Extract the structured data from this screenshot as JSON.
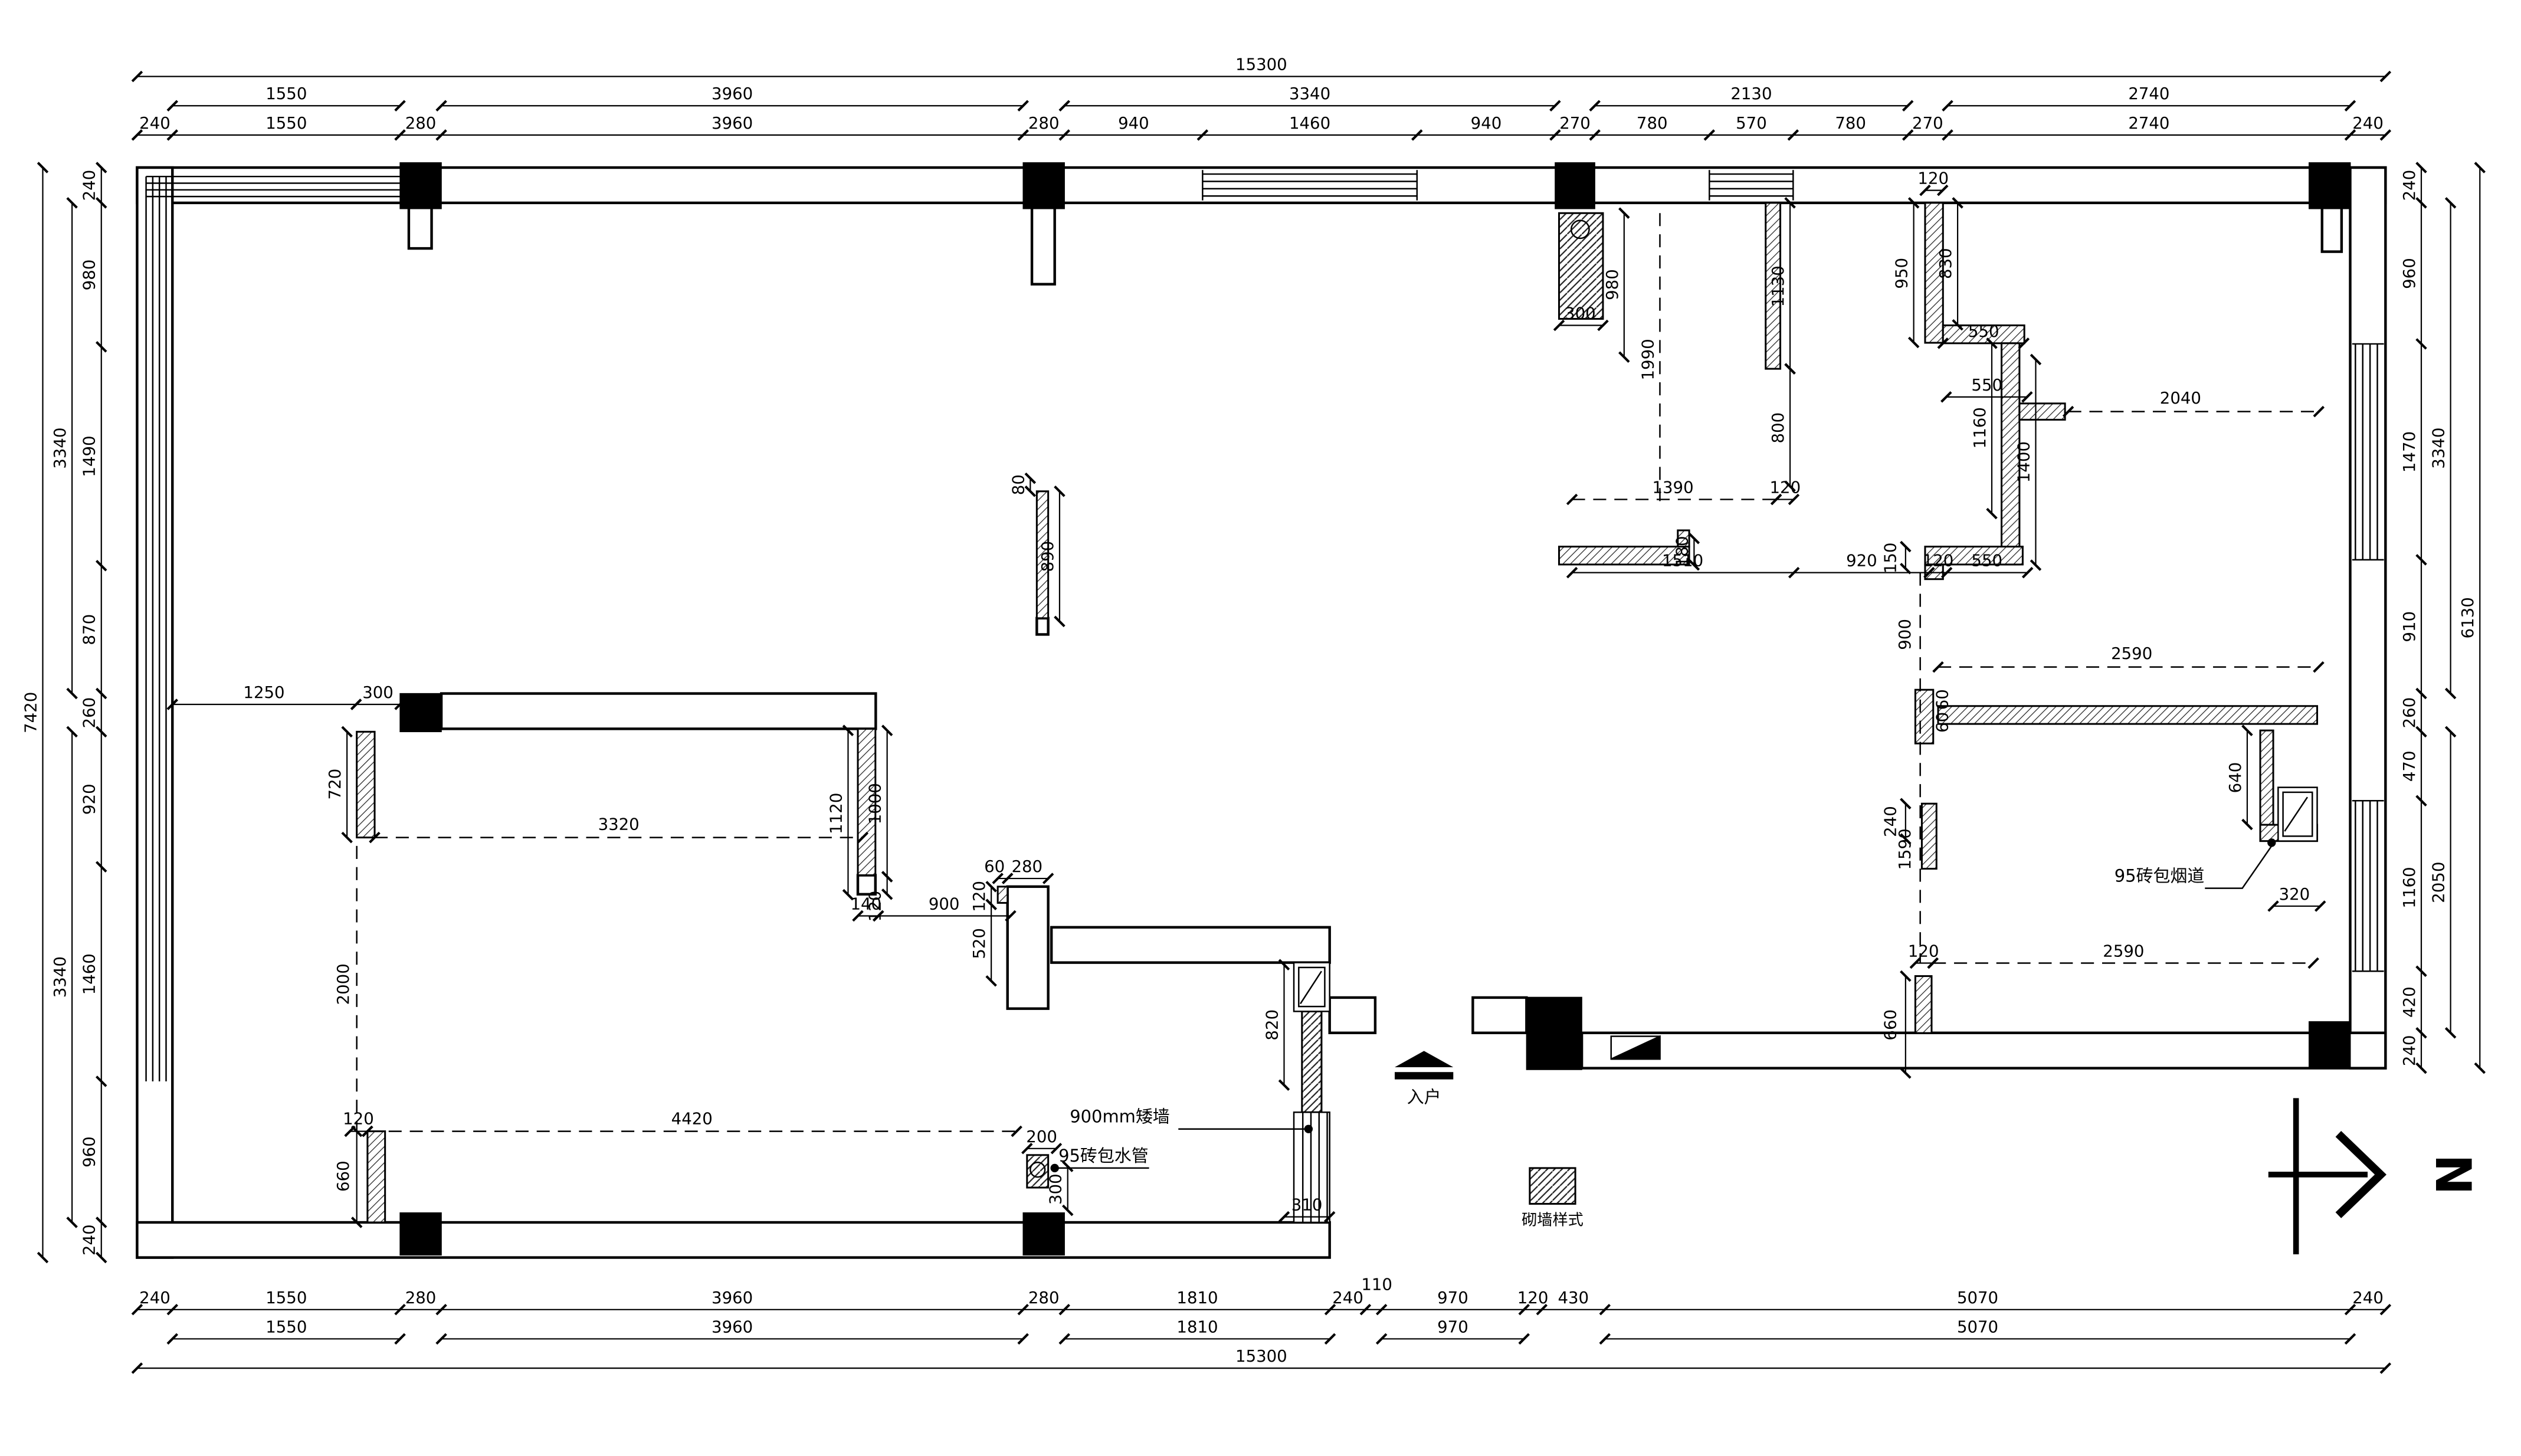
{
  "drawing": {
    "type": "architectural-floor-plan",
    "colors": {
      "line": "#000000",
      "background": "#ffffff"
    },
    "labels": {
      "low_wall": "900mm矮墙",
      "water_pipe": "95砖包水管",
      "flue": "95砖包烟道",
      "entry": "入户",
      "legend": "砌墙样式",
      "north": "N"
    },
    "dims": {
      "top": {
        "r1": [
          "15300"
        ],
        "r2": [
          "1550",
          "3960",
          "3340",
          "2130",
          "2740"
        ],
        "r3": [
          "240",
          "1550",
          "280",
          "3960",
          "280",
          "940",
          "1460",
          "940",
          "270",
          "780",
          "570",
          "780",
          "270",
          "2740",
          "240"
        ]
      },
      "bottom": {
        "r1": [
          "240",
          "1550",
          "280",
          "3960",
          "280",
          "1810",
          "240",
          "110",
          "970",
          "120",
          "430",
          "5070",
          "240"
        ],
        "r2": [
          "1550",
          "3960",
          "1810",
          "970",
          "5070"
        ],
        "r3": [
          "15300"
        ]
      },
      "left": {
        "inner": [
          "240",
          "980",
          "1490",
          "870",
          "260",
          "920",
          "1460",
          "960",
          "240"
        ],
        "mid": [
          "3340",
          "3340"
        ],
        "outer": [
          "7420"
        ]
      },
      "right": {
        "inner": [
          "240",
          "960",
          "1470",
          "910",
          "260",
          "470",
          "1160",
          "420",
          "240"
        ],
        "mid": [
          "3340",
          "2050"
        ],
        "outer": [
          "6130"
        ]
      },
      "interior": [
        "1250",
        "300",
        "720",
        "3320",
        "1120",
        "1000",
        "120",
        "140",
        "900",
        "2000",
        "120",
        "4420",
        "660",
        "80",
        "890",
        "60",
        "280",
        "120",
        "520",
        "820",
        "310",
        "200",
        "300",
        "980",
        "1990",
        "300",
        "1130",
        "800",
        "1390",
        "120",
        "180",
        "120",
        "950",
        "830",
        "550",
        "550",
        "1160",
        "1400",
        "2040",
        "1510",
        "920",
        "120",
        "550",
        "150",
        "900",
        "240",
        "60",
        "60",
        "2590",
        "640",
        "320",
        "1590",
        "120",
        "2590",
        "660"
      ]
    }
  }
}
